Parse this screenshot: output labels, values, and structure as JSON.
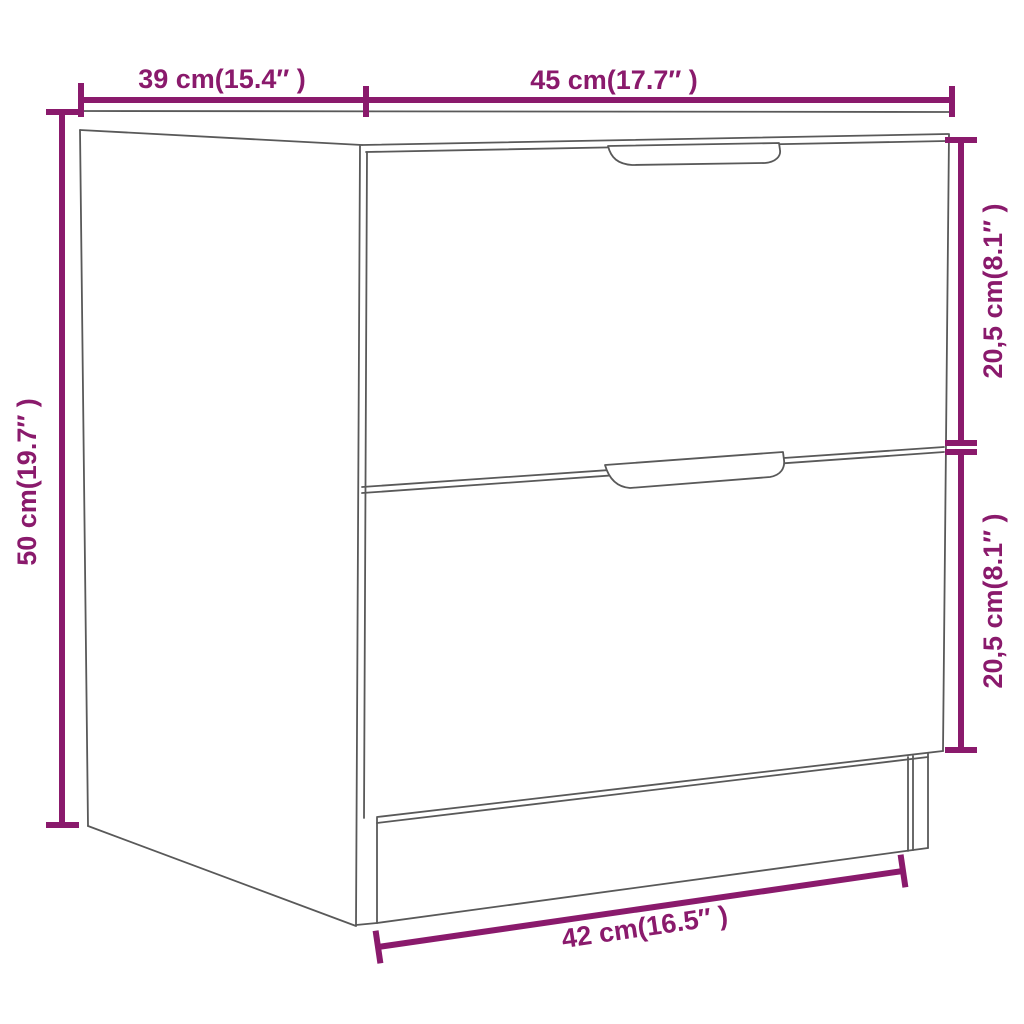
{
  "diagram": {
    "type": "product-dimension-diagram",
    "subject": "two-drawer nightstand line drawing, three-quarter perspective view",
    "background_color": "#ffffff",
    "dimension_color": "#8A1A6C",
    "outline_color": "#595959",
    "labels": {
      "depth_top_left": "39 cm(15.4″ )",
      "width_top_right": "45 cm(17.7″ )",
      "height_left": "50 cm(19.7″ )",
      "drawer_upper_right": "20,5 cm(8.1″ )",
      "drawer_lower_right": "20,5 cm(8.1″ )",
      "bottom_width": "42 cm(16.5″ )"
    }
  }
}
